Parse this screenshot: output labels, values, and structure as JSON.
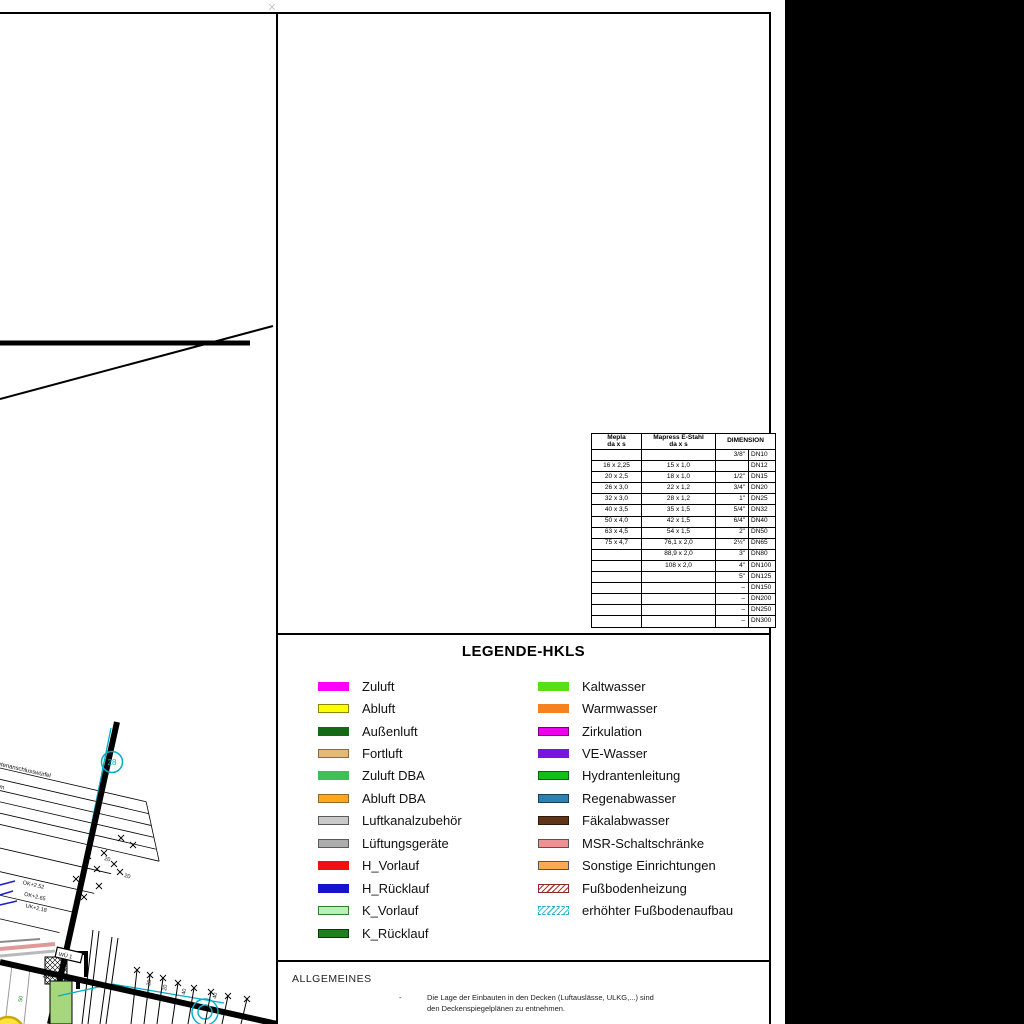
{
  "frame": {
    "background": "#ffffff",
    "margin_band_color": "#000000",
    "line_color": "#000000"
  },
  "pipe_table": {
    "header": {
      "mepla_1": "Mepla",
      "mepla_2": "da x s",
      "mapress_1": "Mapress E-Stahl",
      "mapress_2": "da x s",
      "dimension": "DIMENSION"
    },
    "rows": [
      [
        "",
        "",
        "3/8\"",
        "DN10"
      ],
      [
        "16 x 2,25",
        "15 x 1,0",
        "",
        "DN12"
      ],
      [
        "20 x 2,5",
        "18 x 1,0",
        "1/2\"",
        "DN15"
      ],
      [
        "26 x 3,0",
        "22 x 1,2",
        "3/4\"",
        "DN20"
      ],
      [
        "32 x 3,0",
        "28 x 1,2",
        "1\"",
        "DN25"
      ],
      [
        "40 x 3,5",
        "35 x 1,5",
        "5/4\"",
        "DN32"
      ],
      [
        "50 x 4,0",
        "42 x 1,5",
        "6/4\"",
        "DN40"
      ],
      [
        "63 x 4,5",
        "54 x 1,5",
        "2\"",
        "DN50"
      ],
      [
        "75 x 4,7",
        "76,1 x 2,0",
        "2½\"",
        "DN65"
      ],
      [
        "",
        "88,9 x 2,0",
        "3\"",
        "DN80"
      ],
      [
        "",
        "108 x 2,0",
        "4\"",
        "DN100"
      ],
      [
        "",
        "",
        "5\"",
        "DN125"
      ],
      [
        "",
        "",
        "–",
        "DN150"
      ],
      [
        "",
        "",
        "–",
        "DN200"
      ],
      [
        "",
        "",
        "–",
        "DN250"
      ],
      [
        "",
        "",
        "–",
        "DN300"
      ]
    ]
  },
  "legend": {
    "title": "LEGENDE-HKLS",
    "left": [
      {
        "label": "Zuluft",
        "color": "#FF00FF"
      },
      {
        "label": "Abluft",
        "color": "#FFFF00",
        "border": "#8a8a00"
      },
      {
        "label": "Außenluft",
        "color": "#156815"
      },
      {
        "label": "Fortluft",
        "color": "#E3B878",
        "border": "#8d6b3d"
      },
      {
        "label": "Zuluft DBA",
        "color": "#3FBF54"
      },
      {
        "label": "Abluft DBA",
        "color": "#FFA81D",
        "border": "#8d6b20"
      },
      {
        "label": "Luftkanalzubehör",
        "color": "#C9C9C9",
        "border": "#5a5a5a"
      },
      {
        "label": "Lüftungsgeräte",
        "color": "#ADADAD",
        "border": "#5a5a5a"
      },
      {
        "label": "H_Vorlauf",
        "color": "#F01010"
      },
      {
        "label": "H_Rücklauf",
        "color": "#1414CE"
      },
      {
        "label": "K_Vorlauf",
        "color": "#B9EFB9",
        "border": "#2f7d2f"
      },
      {
        "label": "K_Rücklauf",
        "color": "#1F7F1F",
        "border": "#0b3b0b"
      }
    ],
    "right": [
      {
        "label": "Kaltwasser",
        "color": "#59E014"
      },
      {
        "label": "Warmwasser",
        "color": "#F5821F"
      },
      {
        "label": "Zirkulation",
        "color": "#EE00EE",
        "border": "#770077"
      },
      {
        "label": "VE-Wasser",
        "color": "#7A14DC"
      },
      {
        "label": "Hydrantenleitung",
        "color": "#15BE15",
        "border": "#0a5f0a"
      },
      {
        "label": "Regenabwasser",
        "color": "#2E80B0",
        "border": "#143f57"
      },
      {
        "label": "Fäkalabwasser",
        "color": "#5F3418",
        "border": "#30190a"
      },
      {
        "label": "MSR-Schaltschränke",
        "color": "#F09090",
        "border": "#555555"
      },
      {
        "label": "Sonstige Einrichtungen",
        "color": "#FFAA50",
        "border": "#555555"
      },
      {
        "label": "Fußbodenheizung",
        "color": "#B43434",
        "hatch": true,
        "border": "#8c2a2a"
      },
      {
        "label": "erhöhter Fußbodenaufbau",
        "color": "#38C8DC",
        "hatch": true,
        "border": "#2ab0c4",
        "dash": true
      }
    ]
  },
  "allgemeines": {
    "title": "ALLGEMEINES",
    "bullet": "-",
    "lines": [
      "Die Lage der Einbauten in den Decken (Luftauslässe, ULKG,...) sind",
      "den Deckenspiegelplänen zu entnehmen."
    ]
  },
  "cad": {
    "section_marker": "28",
    "label_box": "WÜ 1",
    "annotation_lines": [
      "N-16+HYGIENE-Mietenanschlusswürfel",
      "Type 20/M",
      "B=1600 mm H=600 mm",
      "99 mm  22 Vol  52 Watt",
      "UK=FFOK+150 mm"
    ],
    "levels": [
      "OK+2.52",
      "OK+2.65",
      "UK+2.18"
    ],
    "dim_labels": [
      "20",
      "20",
      "40",
      "40",
      "115",
      "50"
    ],
    "accent_cyan": "#00AEC8",
    "accent_green_fill": "#A6D77C",
    "accent_yellow": "#FFE33A"
  }
}
